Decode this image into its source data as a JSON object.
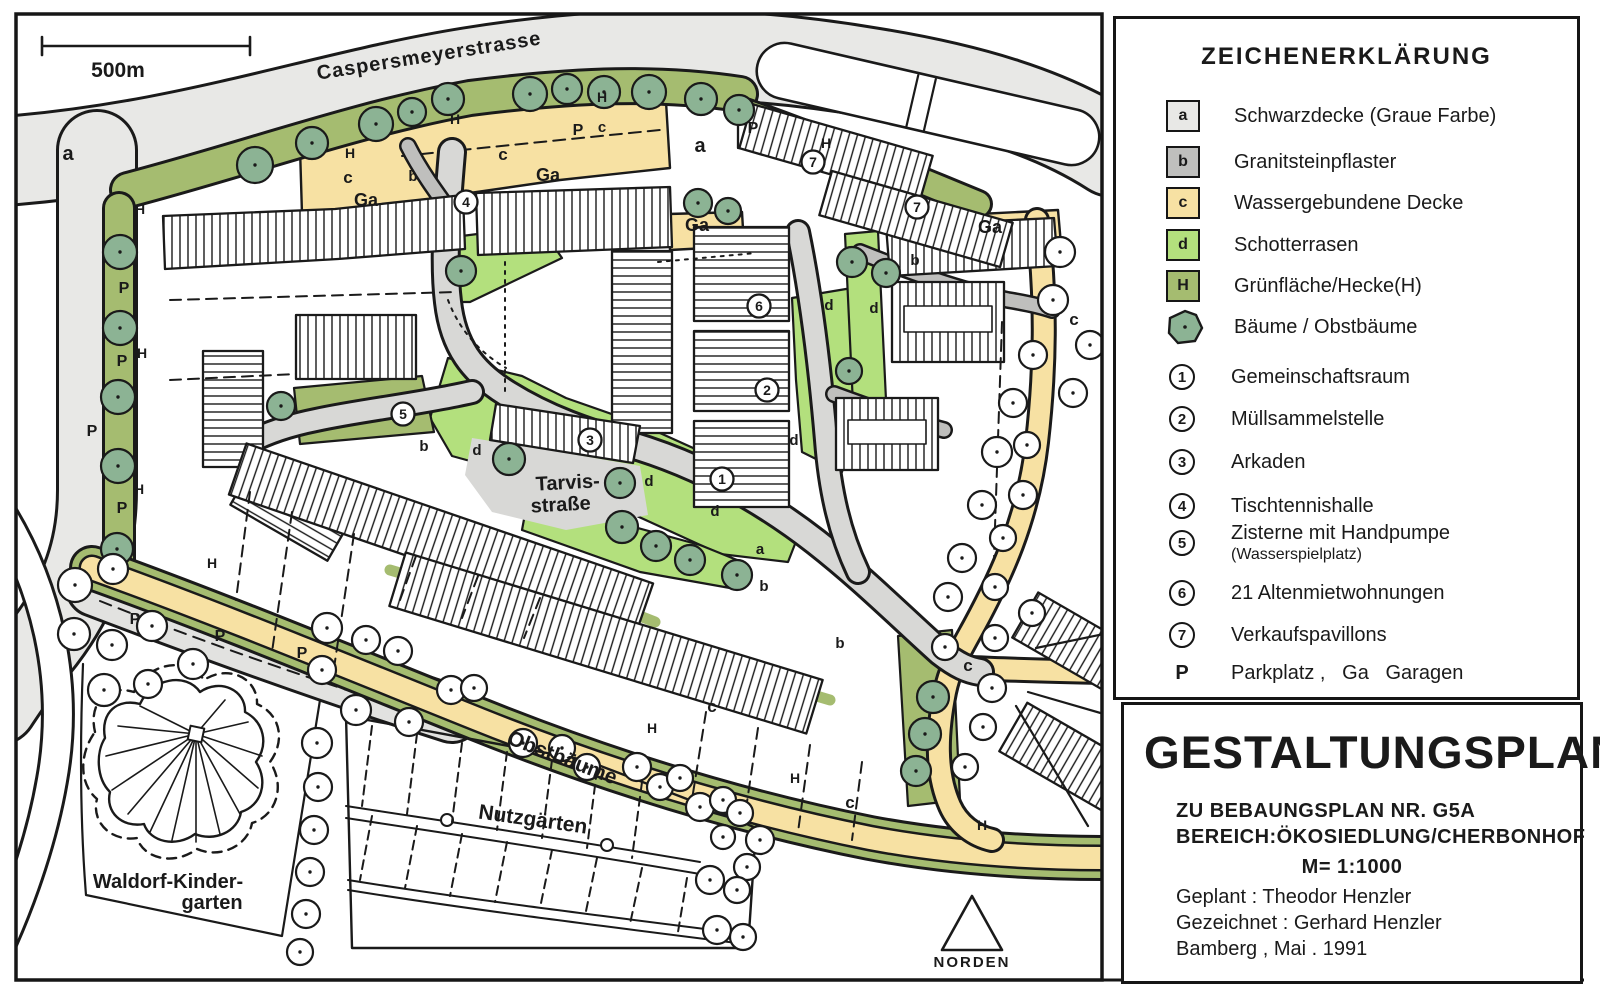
{
  "colors": {
    "ink": "#1a1a1a",
    "road_gray": "#e8e8e6",
    "parking_gray": "#e2e2e0",
    "plaza_gray": "#d8d8d6",
    "granite_gray": "#bfbfbd",
    "water_bound_yellow": "#f7e1a3",
    "schotterrasen_green": "#b3e07d",
    "gruenflaeche_olive": "#a5bc70",
    "tree_sage": "#8cb394"
  },
  "legend": {
    "title": "ZEICHENERKLÄRUNG",
    "items": [
      {
        "key": "a",
        "label": "Schwarzdecke (Graue Farbe)",
        "color": "#e8e8e6"
      },
      {
        "key": "b",
        "label": "Granitsteinpflaster",
        "color": "#bfbfbd"
      },
      {
        "key": "c",
        "label": "Wassergebundene Decke",
        "color": "#f7e1a3"
      },
      {
        "key": "d",
        "label": "Schotterrasen",
        "color": "#b3e07d"
      },
      {
        "key": "H",
        "label": "Grünfläche/Hecke(H)",
        "color": "#a5bc70"
      }
    ],
    "tree_item": {
      "icon": "tree-icon",
      "label": "Bäume / Obstbäume",
      "color": "#8cb394"
    },
    "numbered": [
      {
        "num": "1",
        "label": "Gemeinschaftsraum"
      },
      {
        "num": "2",
        "label": "Müllsammelstelle"
      },
      {
        "num": "3",
        "label": "Arkaden"
      },
      {
        "num": "4",
        "label": "Tischtennishalle"
      },
      {
        "num": "5",
        "label": "Zisterne mit Handpumpe",
        "sub": "(Wasserspielplatz)"
      },
      {
        "num": "6",
        "label": "21 Altenmietwohnungen"
      },
      {
        "num": "7",
        "label": "Verkaufspavillons"
      }
    ],
    "abbrev": {
      "key": "P",
      "label": "Parkplatz ,   Ga   Garagen"
    }
  },
  "title_block": {
    "title": "GESTALTUNGSPLAN",
    "line1": "ZU BEBAUNGSPLAN NR. G5A",
    "line2": "BEREICH:ÖKOSIEDLUNG/CHERBONHOF",
    "scale": "M= 1:1000",
    "planned": "Geplant : Theodor Henzler",
    "drawn": "Gezeichnet : Gerhard Henzler",
    "place_date": "Bamberg , Mai . 1991"
  },
  "map": {
    "scale_bar_label": "500m",
    "north_label": "NORDEN",
    "texts": [
      {
        "t": "Caspersmeyerstrasse",
        "x": 430,
        "y": 62,
        "s": 20,
        "rot": -9,
        "ls": 1,
        "name": "street-label-caspersmeyerstrasse"
      },
      {
        "t": "Tarvis-",
        "x": 568,
        "y": 489,
        "s": 20,
        "rot": -3,
        "name": "street-label-tarvisstrasse-1"
      },
      {
        "t": "straße",
        "x": 561,
        "y": 511,
        "s": 20,
        "rot": -3,
        "name": "street-label-tarvisstrasse-2"
      },
      {
        "t": "Obstbäume",
        "x": 560,
        "y": 764,
        "s": 21,
        "rot": 21,
        "name": "area-label-obstbaeume"
      },
      {
        "t": "Nutzgärten",
        "x": 532,
        "y": 826,
        "s": 21,
        "rot": 8,
        "name": "area-label-nutzgaerten"
      },
      {
        "t": "Waldorf-Kinder-",
        "x": 168,
        "y": 888,
        "s": 20,
        "name": "area-label-waldorf-kindergarten-1"
      },
      {
        "t": "garten",
        "x": 212,
        "y": 909,
        "s": 20,
        "name": "area-label-waldorf-kindergarten-2"
      },
      {
        "t": "NORDEN",
        "x": 972,
        "y": 967,
        "s": 15,
        "ls": 2,
        "name": "north-label"
      },
      {
        "t": "500m",
        "x": 118,
        "y": 77,
        "s": 21,
        "w": 700,
        "name": "scale-label"
      },
      {
        "t": "a",
        "x": 68,
        "y": 160,
        "s": 20
      },
      {
        "t": "a",
        "x": 700,
        "y": 152,
        "s": 20
      },
      {
        "t": "a",
        "x": 760,
        "y": 554,
        "s": 15
      },
      {
        "t": "H",
        "x": 140,
        "y": 214,
        "s": 14
      },
      {
        "t": "H",
        "x": 350,
        "y": 158,
        "s": 14
      },
      {
        "t": "H",
        "x": 455,
        "y": 124,
        "s": 14
      },
      {
        "t": "H",
        "x": 602,
        "y": 102,
        "s": 14
      },
      {
        "t": "H",
        "x": 142,
        "y": 358,
        "s": 14
      },
      {
        "t": "H",
        "x": 139,
        "y": 494,
        "s": 14
      },
      {
        "t": "H",
        "x": 212,
        "y": 568,
        "s": 14
      },
      {
        "t": "H",
        "x": 826,
        "y": 148,
        "s": 14
      },
      {
        "t": "H",
        "x": 652,
        "y": 733,
        "s": 14
      },
      {
        "t": "H",
        "x": 795,
        "y": 783,
        "s": 14
      },
      {
        "t": "H",
        "x": 982,
        "y": 830,
        "s": 14
      },
      {
        "t": "c",
        "x": 348,
        "y": 183,
        "s": 17
      },
      {
        "t": "c",
        "x": 503,
        "y": 160,
        "s": 17
      },
      {
        "t": "c",
        "x": 602,
        "y": 132,
        "s": 15
      },
      {
        "t": "c",
        "x": 1074,
        "y": 325,
        "s": 17
      },
      {
        "t": "c",
        "x": 968,
        "y": 671,
        "s": 17
      },
      {
        "t": "c",
        "x": 712,
        "y": 712,
        "s": 17
      },
      {
        "t": "c",
        "x": 850,
        "y": 808,
        "s": 17
      },
      {
        "t": "Ga",
        "x": 366,
        "y": 206,
        "s": 18
      },
      {
        "t": "Ga",
        "x": 548,
        "y": 181,
        "s": 18
      },
      {
        "t": "Ga",
        "x": 990,
        "y": 233,
        "s": 18
      },
      {
        "t": "Ga",
        "x": 697,
        "y": 231,
        "s": 18
      },
      {
        "t": "b",
        "x": 413,
        "y": 181,
        "s": 15
      },
      {
        "t": "b",
        "x": 915,
        "y": 265,
        "s": 15
      },
      {
        "t": "b",
        "x": 764,
        "y": 591,
        "s": 15
      },
      {
        "t": "b",
        "x": 840,
        "y": 648,
        "s": 15
      },
      {
        "t": "b",
        "x": 424,
        "y": 451,
        "s": 15
      },
      {
        "t": "d",
        "x": 477,
        "y": 455,
        "s": 15
      },
      {
        "t": "d",
        "x": 649,
        "y": 486,
        "s": 15
      },
      {
        "t": "d",
        "x": 715,
        "y": 516,
        "s": 15
      },
      {
        "t": "d",
        "x": 794,
        "y": 445,
        "s": 15
      },
      {
        "t": "d",
        "x": 829,
        "y": 310,
        "s": 15
      },
      {
        "t": "d",
        "x": 874,
        "y": 313,
        "s": 15
      },
      {
        "t": "P",
        "x": 578,
        "y": 135,
        "s": 16
      },
      {
        "t": "P",
        "x": 753,
        "y": 133,
        "s": 16
      },
      {
        "t": "P",
        "x": 124,
        "y": 293,
        "s": 16
      },
      {
        "t": "P",
        "x": 122,
        "y": 366,
        "s": 16
      },
      {
        "t": "P",
        "x": 92,
        "y": 436,
        "s": 16
      },
      {
        "t": "P",
        "x": 122,
        "y": 513,
        "s": 16
      },
      {
        "t": "P",
        "x": 135,
        "y": 624,
        "s": 16
      },
      {
        "t": "P",
        "x": 220,
        "y": 641,
        "s": 16
      },
      {
        "t": "P",
        "x": 302,
        "y": 658,
        "s": 16
      }
    ],
    "markers": [
      {
        "n": "1",
        "x": 722,
        "y": 479
      },
      {
        "n": "2",
        "x": 767,
        "y": 390
      },
      {
        "n": "3",
        "x": 590,
        "y": 440
      },
      {
        "n": "4",
        "x": 466,
        "y": 202
      },
      {
        "n": "5",
        "x": 403,
        "y": 414
      },
      {
        "n": "6",
        "x": 759,
        "y": 306
      },
      {
        "n": "7",
        "x": 813,
        "y": 162
      },
      {
        "n": "7",
        "x": 917,
        "y": 207
      }
    ]
  }
}
